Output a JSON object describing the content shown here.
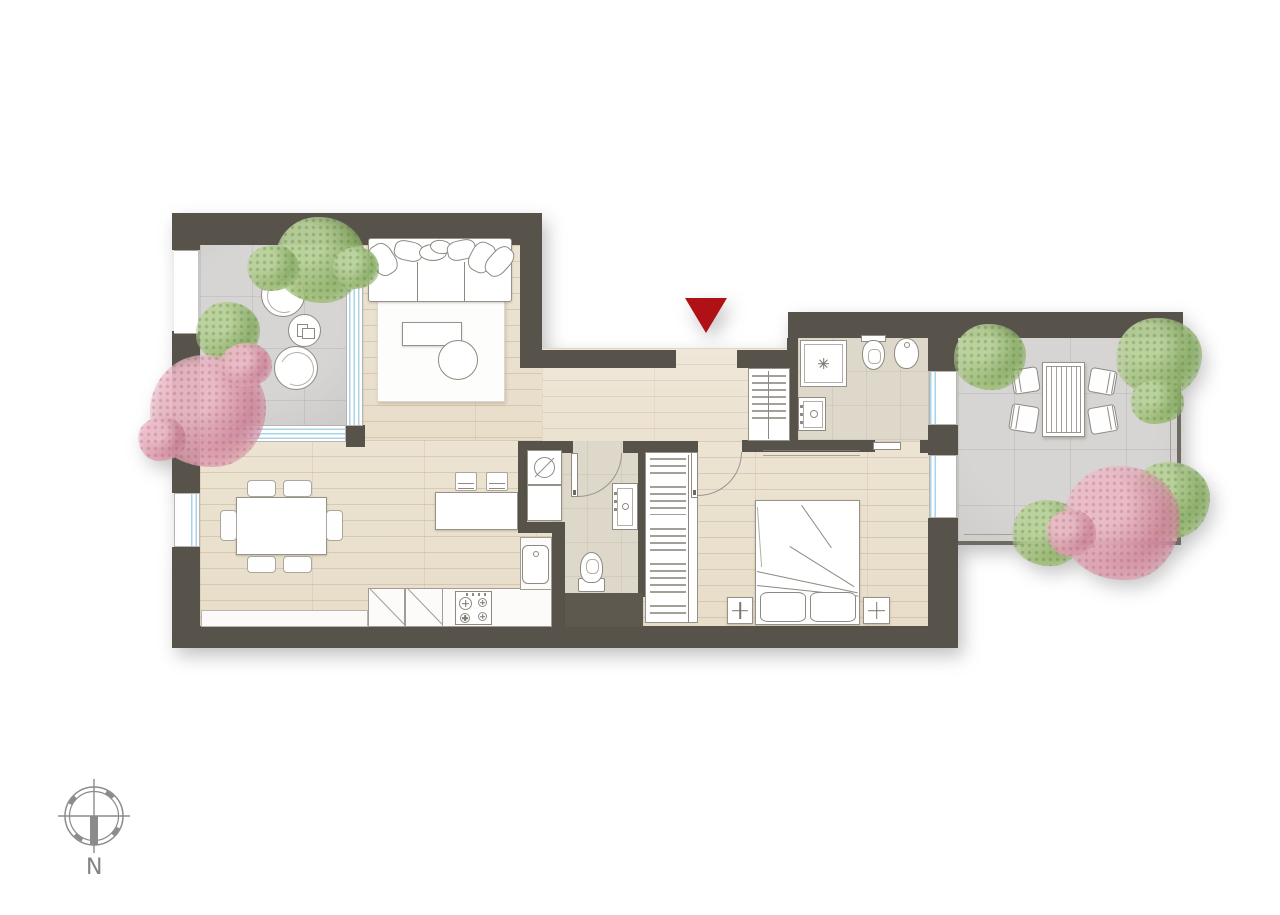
{
  "compass": {
    "label": "N"
  },
  "icons": {
    "entrance-marker-icon": "▼",
    "compass-rose-icon": "⊕",
    "washing-machine-icon": "⊘",
    "shower-drain-icon": "✦",
    "nightstand-star-icon": "✚"
  },
  "colors": {
    "entrance_marker": "#b01116",
    "wall": "#57534b",
    "wood_floor": "#ebe2d1",
    "hall_floor": "#eee6d6",
    "terrace_tile": "#d2d1cf",
    "bathroom_tile": "#ded8ca",
    "window_glass": "#a9d3e8",
    "foliage_green": "#9ab97c",
    "foliage_pink": "#dba3b4",
    "compass_gray": "#8b8b8b",
    "page_background": "#ffffff"
  }
}
